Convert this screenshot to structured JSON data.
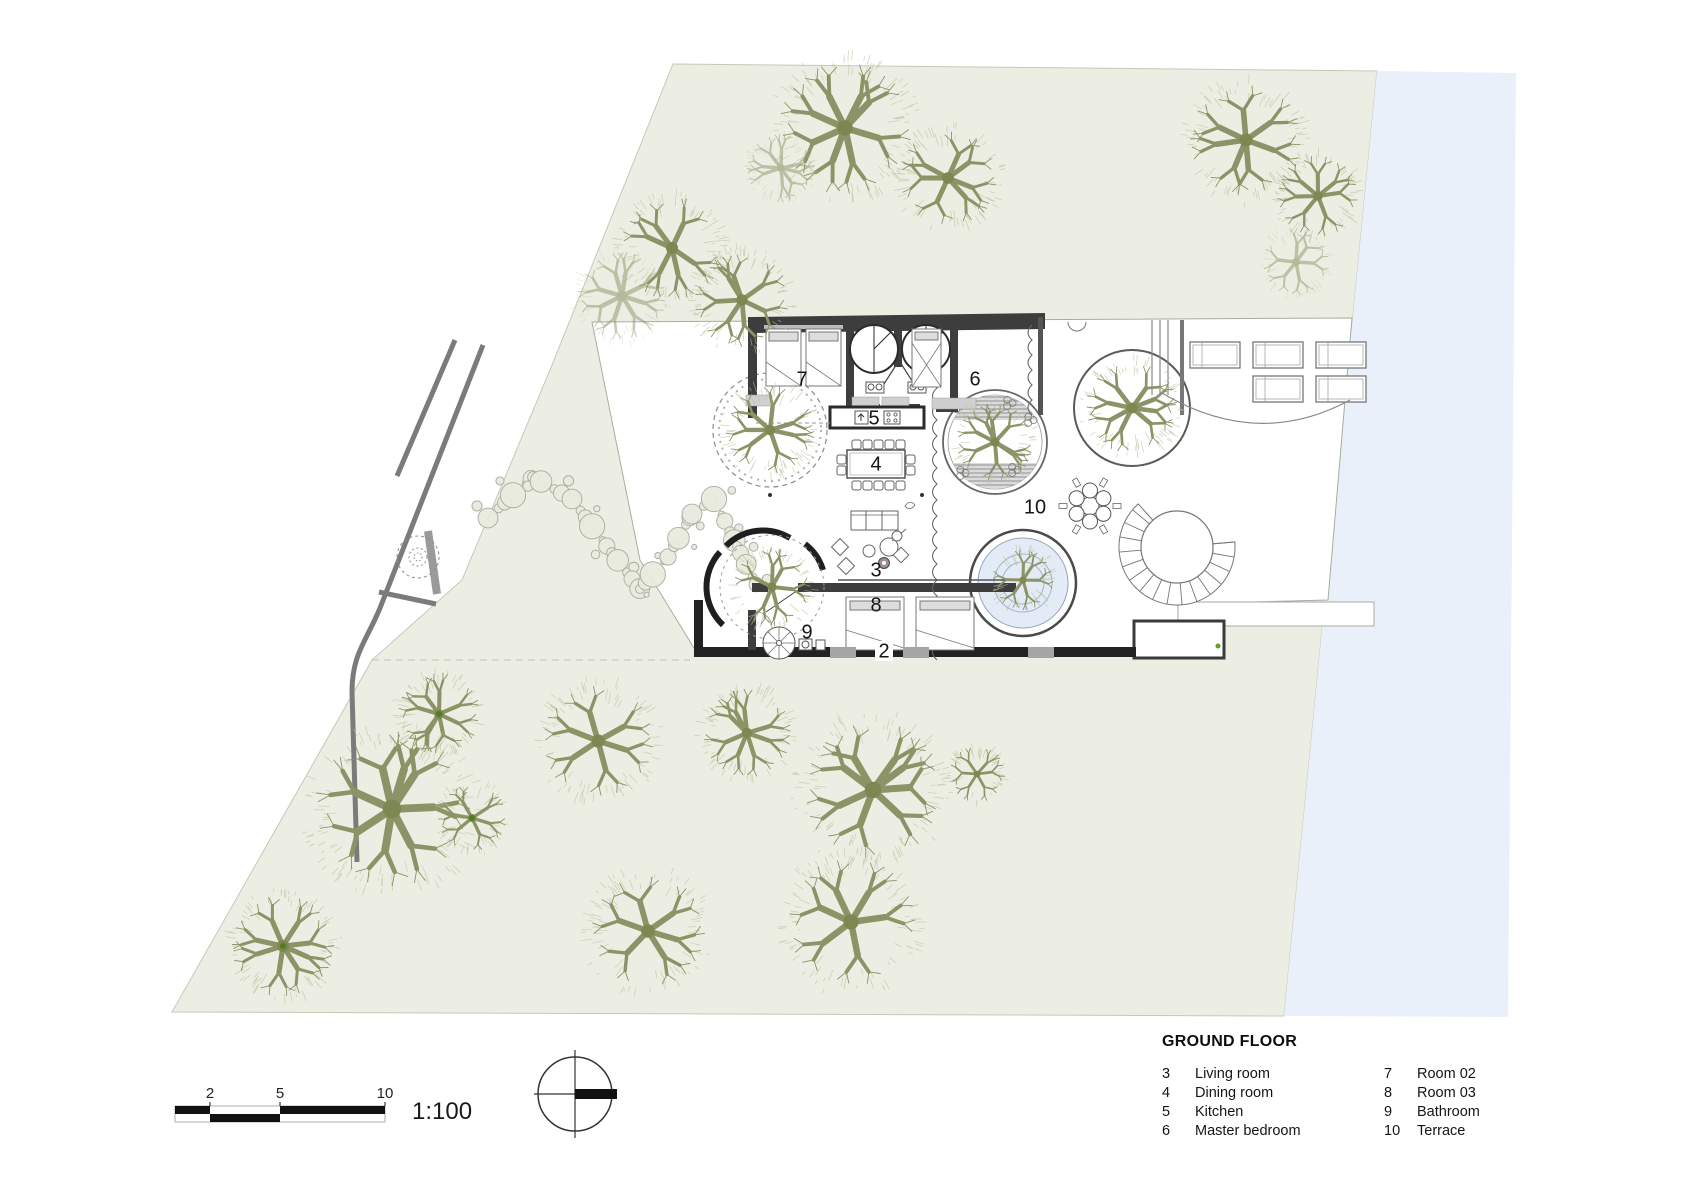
{
  "sheet": {
    "scale_bar": {
      "ticks": [
        "2",
        "5",
        "10"
      ],
      "ratio": "1:100"
    },
    "compass": "north-indicator"
  },
  "plan": {
    "labels": [
      {
        "text": "7",
        "x": 802,
        "y": 380
      },
      {
        "text": "5",
        "x": 874,
        "y": 419
      },
      {
        "text": "6",
        "x": 975,
        "y": 380
      },
      {
        "text": "4",
        "x": 876,
        "y": 465
      },
      {
        "text": "3",
        "x": 876,
        "y": 571
      },
      {
        "text": "8",
        "x": 876,
        "y": 606
      },
      {
        "text": "10",
        "x": 1035,
        "y": 508
      },
      {
        "text": "9",
        "x": 807,
        "y": 633
      },
      {
        "text": "2",
        "x": 884,
        "y": 652
      }
    ],
    "tick_pos": [
      {
        "x": 210,
        "y": 1102
      },
      {
        "x": 280,
        "y": 1102
      },
      {
        "x": 385,
        "y": 1102
      }
    ],
    "ratio_pos": {
      "x": 412,
      "y": 1112
    }
  },
  "legend": {
    "title": "GROUND FLOOR",
    "col1": [
      {
        "num": "3",
        "label": "Living room"
      },
      {
        "num": "4",
        "label": "Dining room"
      },
      {
        "num": "5",
        "label": "Kitchen"
      },
      {
        "num": "6",
        "label": "Master bedroom"
      }
    ],
    "col2": [
      {
        "num": "7",
        "label": "Room 02"
      },
      {
        "num": "8",
        "label": "Room 03"
      },
      {
        "num": "9",
        "label": "Bathroom"
      },
      {
        "num": "10",
        "label": "Terrace"
      }
    ]
  },
  "site": {
    "colors": {
      "grass": "#edeee3",
      "water": "#e9f0fa",
      "branch": "#8c9367",
      "fringe": "#bcc29e",
      "trunk": "#7d8752",
      "wall": "#3d3d3d",
      "road": "#7b7b7b",
      "pool": "#e3ecf6",
      "dot_green": "#4f7d1f"
    },
    "trees": [
      [
        845,
        128,
        78,
        1,
        0
      ],
      [
        948,
        178,
        58,
        2,
        0
      ],
      [
        781,
        168,
        40,
        3,
        1
      ],
      [
        672,
        248,
        60,
        4,
        0
      ],
      [
        1246,
        140,
        66,
        5,
        0
      ],
      [
        1318,
        196,
        48,
        6,
        0
      ],
      [
        1296,
        262,
        40,
        7,
        1
      ],
      [
        622,
        296,
        52,
        8,
        1
      ],
      [
        742,
        300,
        56,
        9,
        0
      ],
      [
        770,
        430,
        52,
        10,
        0
      ],
      [
        772,
        587,
        46,
        11,
        0
      ],
      [
        995,
        442,
        46,
        12,
        0
      ],
      [
        1132,
        408,
        54,
        13,
        0
      ],
      [
        1023,
        580,
        36,
        14,
        0
      ],
      [
        439,
        714,
        48,
        15,
        2
      ],
      [
        392,
        809,
        92,
        16,
        0
      ],
      [
        472,
        818,
        40,
        17,
        2
      ],
      [
        598,
        741,
        66,
        18,
        0
      ],
      [
        747,
        733,
        52,
        19,
        0
      ],
      [
        873,
        790,
        82,
        20,
        0
      ],
      [
        977,
        774,
        33,
        21,
        0
      ],
      [
        283,
        946,
        60,
        22,
        2
      ],
      [
        648,
        931,
        68,
        23,
        0
      ],
      [
        851,
        922,
        76,
        24,
        0
      ]
    ],
    "shrub_path": [
      [
        488,
        518
      ],
      [
        533,
        477
      ],
      [
        572,
        499
      ],
      [
        612,
        553
      ],
      [
        640,
        589
      ],
      [
        668,
        557
      ],
      [
        692,
        514
      ],
      [
        714,
        499
      ],
      [
        737,
        546
      ],
      [
        757,
        586
      ]
    ]
  }
}
